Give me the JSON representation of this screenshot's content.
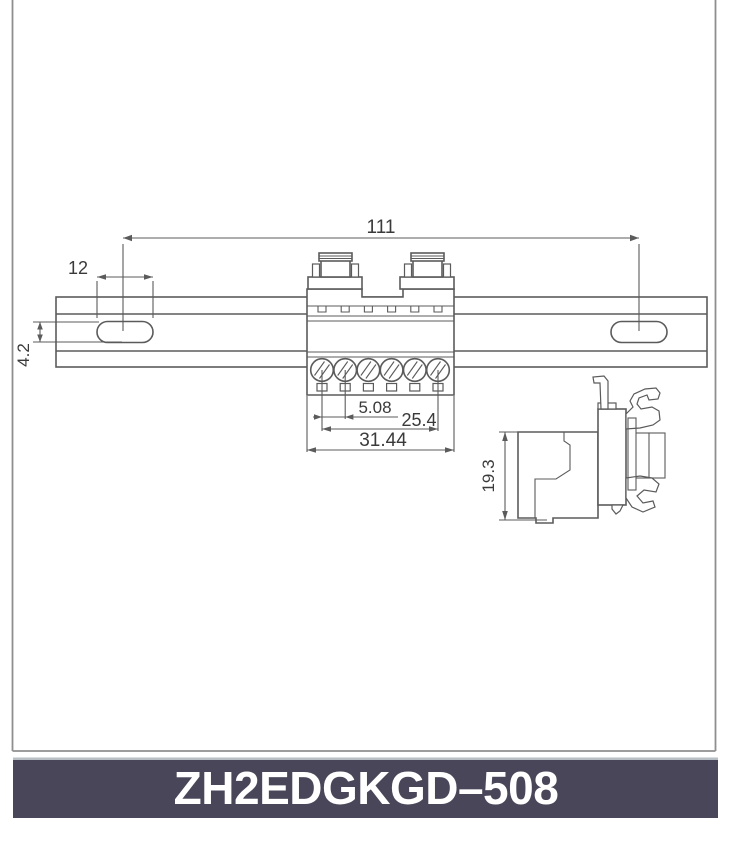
{
  "drawing": {
    "front_view": {
      "dim_rail_hole_span": "111",
      "dim_slot_width": "12",
      "dim_slot_height": "4.2",
      "dim_pin_pitch": "5.08",
      "dim_pin_span": "25.4",
      "dim_block_width": "31.44"
    },
    "side_view": {
      "dim_height": "19.3"
    }
  },
  "footer": {
    "model_number": "ZH2EDGKGD–508"
  },
  "colors": {
    "line": "#5b5b5b",
    "dim_text": "#3a3a3a",
    "frame_line": "#8f8f8f",
    "title_bar_bg": "#494659",
    "title_bar_top_edge": "#b7bfc4",
    "title_text": "#ffffff"
  }
}
